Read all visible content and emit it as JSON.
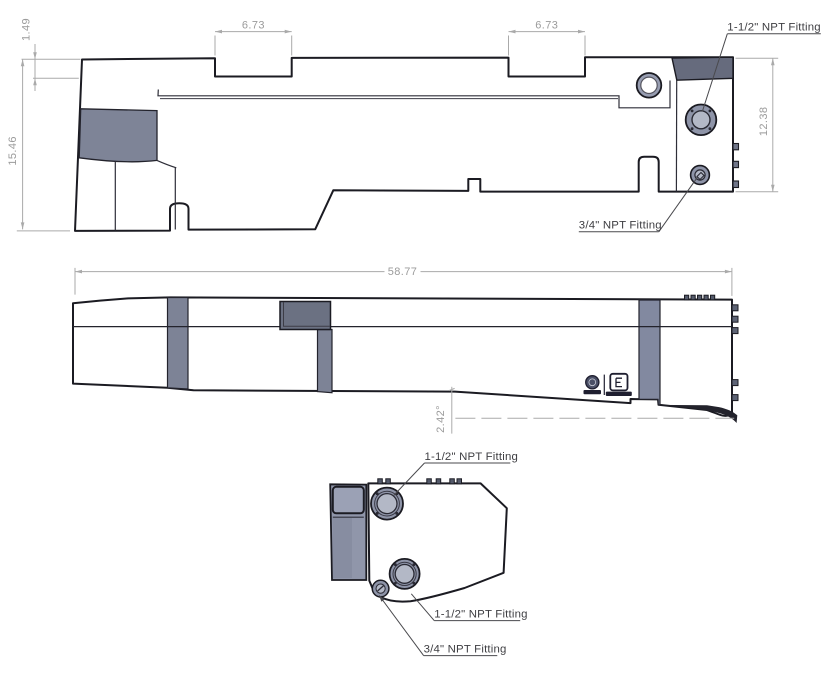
{
  "drawing": {
    "background": "#ffffff",
    "part_colors": {
      "plan_face": "#979db1",
      "plan_dark_band": "#666b7d",
      "plan_dark_patch": "#7e8497",
      "side_face": "#666c7d",
      "end_face": "#9ba1b5",
      "fitting_flange": "#8e94a8",
      "fitting_inner": "#b3b8c6",
      "edge": "#1b1b22"
    },
    "top_view": {
      "dim_lip": "1.49",
      "dim_height": "15.46",
      "dim_notch_left": "6.73",
      "dim_notch_right": "6.73",
      "dim_right_width": "12.38",
      "label_large_fitting": "1-1/2\" NPT Fitting",
      "label_small_fitting": "3/4\" NPT Fitting"
    },
    "side_view": {
      "dim_length": "58.77",
      "dim_angle": "2.42°"
    },
    "end_view": {
      "label_fitting_top": "1-1/2\" NPT Fitting",
      "label_fitting_mid": "1-1/2\" NPT Fitting",
      "label_fitting_small": "3/4\" NPT Fitting"
    }
  }
}
